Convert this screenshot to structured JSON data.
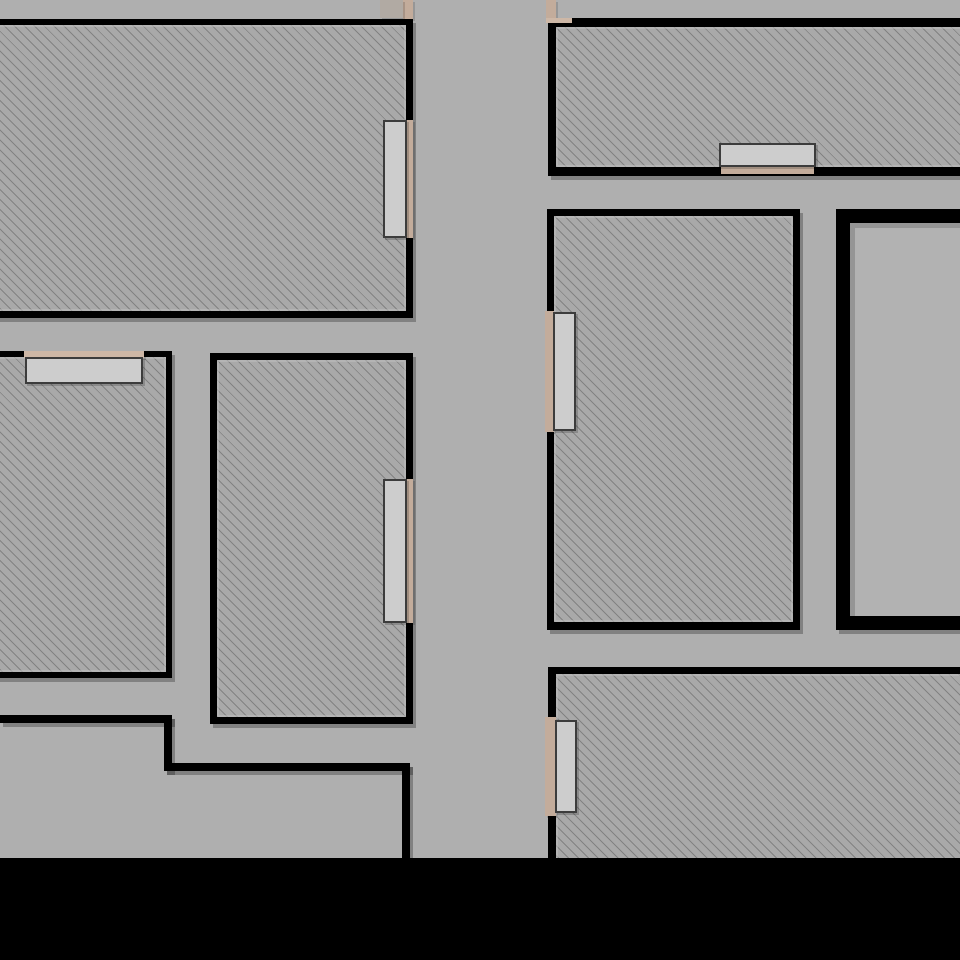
{
  "canvas": {
    "width": 960,
    "height": 960,
    "background": "#AFAFAF"
  },
  "palette": {
    "wall": "#000000",
    "wall_shadow": "rgba(0,0,0,0.26)",
    "hatch_fill": "#A9A9A9",
    "hatch_line": "#6E6E6E",
    "plain_room_fill": "#B2B2B2",
    "door_leaf_fill": "#CDCDCD",
    "door_leaf_border": "#3C3C3C",
    "frame_tan": "#C3AC9B",
    "sill_tan": "#CDB7A6",
    "warm_strip": "#B1AAA3",
    "void_black": "#000000"
  },
  "plan": {
    "rooms": [
      {
        "name": "room-top-left",
        "x": -8,
        "y": 19,
        "w": 421,
        "h": 299,
        "wt": 6,
        "wr": 7,
        "wb": 7,
        "wl": 0,
        "fill": "hatch"
      },
      {
        "name": "room-top-right",
        "x": 548,
        "y": 18,
        "w": 420,
        "h": 158,
        "wt": 9,
        "wr": 0,
        "wb": 9,
        "wl": 8,
        "fill": "hatch"
      },
      {
        "name": "room-mid-left",
        "x": -8,
        "y": 351,
        "w": 180,
        "h": 327,
        "wt": 6,
        "wr": 6,
        "wb": 6,
        "wl": 0,
        "fill": "hatch"
      },
      {
        "name": "room-mid-center",
        "x": 210,
        "y": 353,
        "w": 203,
        "h": 371,
        "wt": 7,
        "wr": 7,
        "wb": 7,
        "wl": 7,
        "fill": "hatch"
      },
      {
        "name": "room-mid-right",
        "x": 547,
        "y": 209,
        "w": 253,
        "h": 421,
        "wt": 7,
        "wr": 7,
        "wb": 8,
        "wl": 7,
        "fill": "hatch"
      },
      {
        "name": "room-far-right",
        "x": 836,
        "y": 209,
        "w": 132,
        "h": 421,
        "wt": 14,
        "wr": 0,
        "wb": 14,
        "wl": 14,
        "fill": "plain"
      },
      {
        "name": "room-bottom-right",
        "x": 548,
        "y": 667,
        "w": 420,
        "h": 199,
        "wt": 7,
        "wr": 0,
        "wb": 0,
        "wl": 8,
        "fill": "hatch"
      }
    ],
    "doors": [
      {
        "name": "door-top-left-room-east",
        "leaf": {
          "x": 383,
          "y": 120,
          "w": 24,
          "h": 118
        },
        "frame": {
          "x": 406,
          "y": 120,
          "w": 7,
          "h": 118
        },
        "frame_color": "frame_tan"
      },
      {
        "name": "window-top-right-room-south",
        "leaf": {
          "x": 719,
          "y": 143,
          "w": 97,
          "h": 24
        },
        "frame": {
          "x": 721,
          "y": 167,
          "w": 93,
          "h": 7
        },
        "frame_color": "frame_tan"
      },
      {
        "name": "window-mid-left-room-north",
        "leaf": {
          "x": 25,
          "y": 357,
          "w": 118,
          "h": 27
        },
        "frame": {
          "x": 24,
          "y": 351,
          "w": 120,
          "h": 7
        },
        "frame_color": "sill_tan"
      },
      {
        "name": "door-mid-center-room-east",
        "leaf": {
          "x": 383,
          "y": 479,
          "w": 24,
          "h": 144
        },
        "frame": {
          "x": 406,
          "y": 479,
          "w": 7,
          "h": 144
        },
        "frame_color": "frame_tan"
      },
      {
        "name": "door-mid-right-room-west",
        "leaf": {
          "x": 553,
          "y": 312,
          "w": 23,
          "h": 119
        },
        "frame": {
          "x": 545,
          "y": 311,
          "w": 9,
          "h": 121
        },
        "frame_color": "frame_tan"
      },
      {
        "name": "door-bottom-right-room-west",
        "leaf": {
          "x": 555,
          "y": 720,
          "w": 22,
          "h": 93
        },
        "frame": {
          "x": 545,
          "y": 717,
          "w": 11,
          "h": 99
        },
        "frame_color": "frame_tan"
      }
    ],
    "frames": [
      {
        "name": "door-frame-corridor-north-west",
        "x": 403,
        "y": 0,
        "w": 10,
        "h": 19,
        "color": "frame_tan"
      },
      {
        "name": "door-frame-corridor-north-east",
        "x": 546,
        "y": 0,
        "w": 10,
        "h": 19,
        "color": "frame_tan"
      },
      {
        "name": "sill-corridor-north-west",
        "x": 380,
        "y": 0,
        "w": 23,
        "h": 18,
        "color": "warm_strip"
      },
      {
        "name": "sill-top-right-corner",
        "x": 546,
        "y": 18,
        "w": 26,
        "h": 5,
        "color": "sill_tan"
      }
    ],
    "walls": [
      {
        "name": "wall-step-west-top",
        "x": 0,
        "y": 715,
        "w": 172,
        "h": 8
      },
      {
        "name": "wall-step-west-vertical",
        "x": 164,
        "y": 715,
        "w": 8,
        "h": 56
      },
      {
        "name": "wall-step-south",
        "x": 164,
        "y": 763,
        "w": 246,
        "h": 8
      },
      {
        "name": "wall-step-east-vertical",
        "x": 402,
        "y": 763,
        "w": 8,
        "h": 97
      }
    ],
    "voids": [
      {
        "name": "void-bottom-band",
        "x": 0,
        "y": 858,
        "w": 960,
        "h": 102
      }
    ]
  }
}
